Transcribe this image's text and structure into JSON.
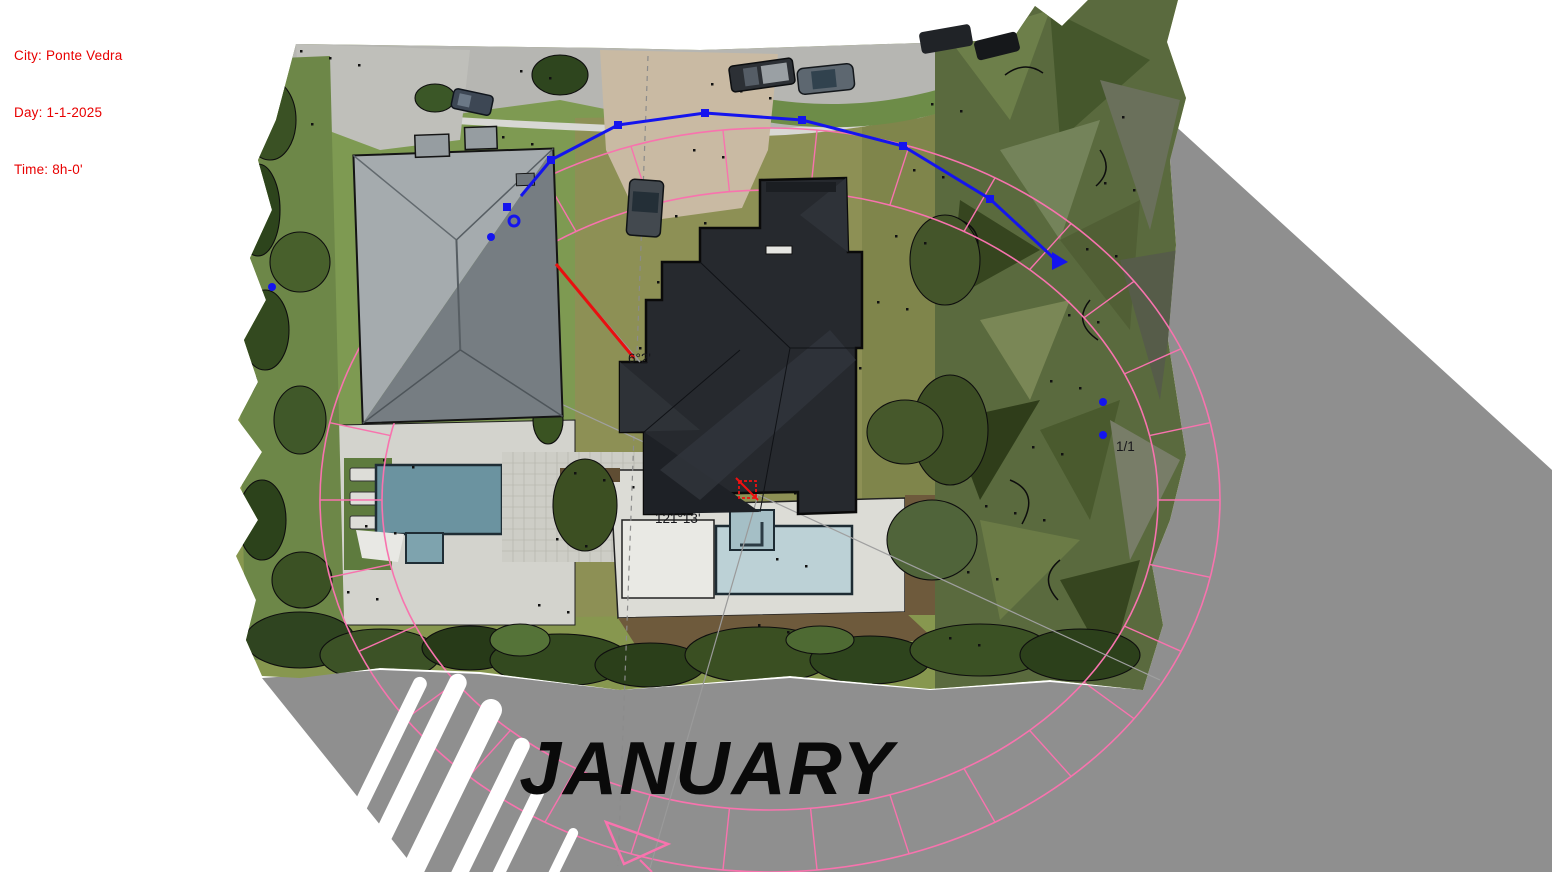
{
  "overlay": {
    "city_line": "City: Ponte Vedra",
    "day_line": "Day: 1-1-2025",
    "time_line": "Time: 8h-0'"
  },
  "sun_study": {
    "month_label": "JANUARY",
    "date_label": "1/1",
    "altitude_label": "6°2'",
    "azimuth_label": "121°13'"
  },
  "sun_path": {
    "polyline_points": "521,196 551,160 618,125 705,113 802,120 903,146 990,199 1058,262",
    "nodes": [
      {
        "x": 551,
        "y": 160,
        "type": "square"
      },
      {
        "x": 618,
        "y": 125,
        "type": "square"
      },
      {
        "x": 705,
        "y": 113,
        "type": "square"
      },
      {
        "x": 802,
        "y": 120,
        "type": "square"
      },
      {
        "x": 903,
        "y": 146,
        "type": "square"
      },
      {
        "x": 990,
        "y": 199,
        "type": "square"
      }
    ],
    "detached_markers": [
      {
        "x": 507,
        "y": 207,
        "type": "square"
      },
      {
        "x": 514,
        "y": 221,
        "type": "ring"
      },
      {
        "x": 491,
        "y": 237,
        "type": "dot"
      },
      {
        "x": 272,
        "y": 287,
        "type": "dot"
      },
      {
        "x": 1103,
        "y": 402,
        "type": "dot"
      },
      {
        "x": 1103,
        "y": 435,
        "type": "dot"
      }
    ]
  },
  "colors": {
    "shadow_gray": "#8f8f8f",
    "sun_path_blue": "#1414ee",
    "compass_pink": "#f873ae",
    "sun_ray_red": "#e81010",
    "annotation_red_text": "#e80000",
    "month_text_black": "#0a0a0a"
  }
}
